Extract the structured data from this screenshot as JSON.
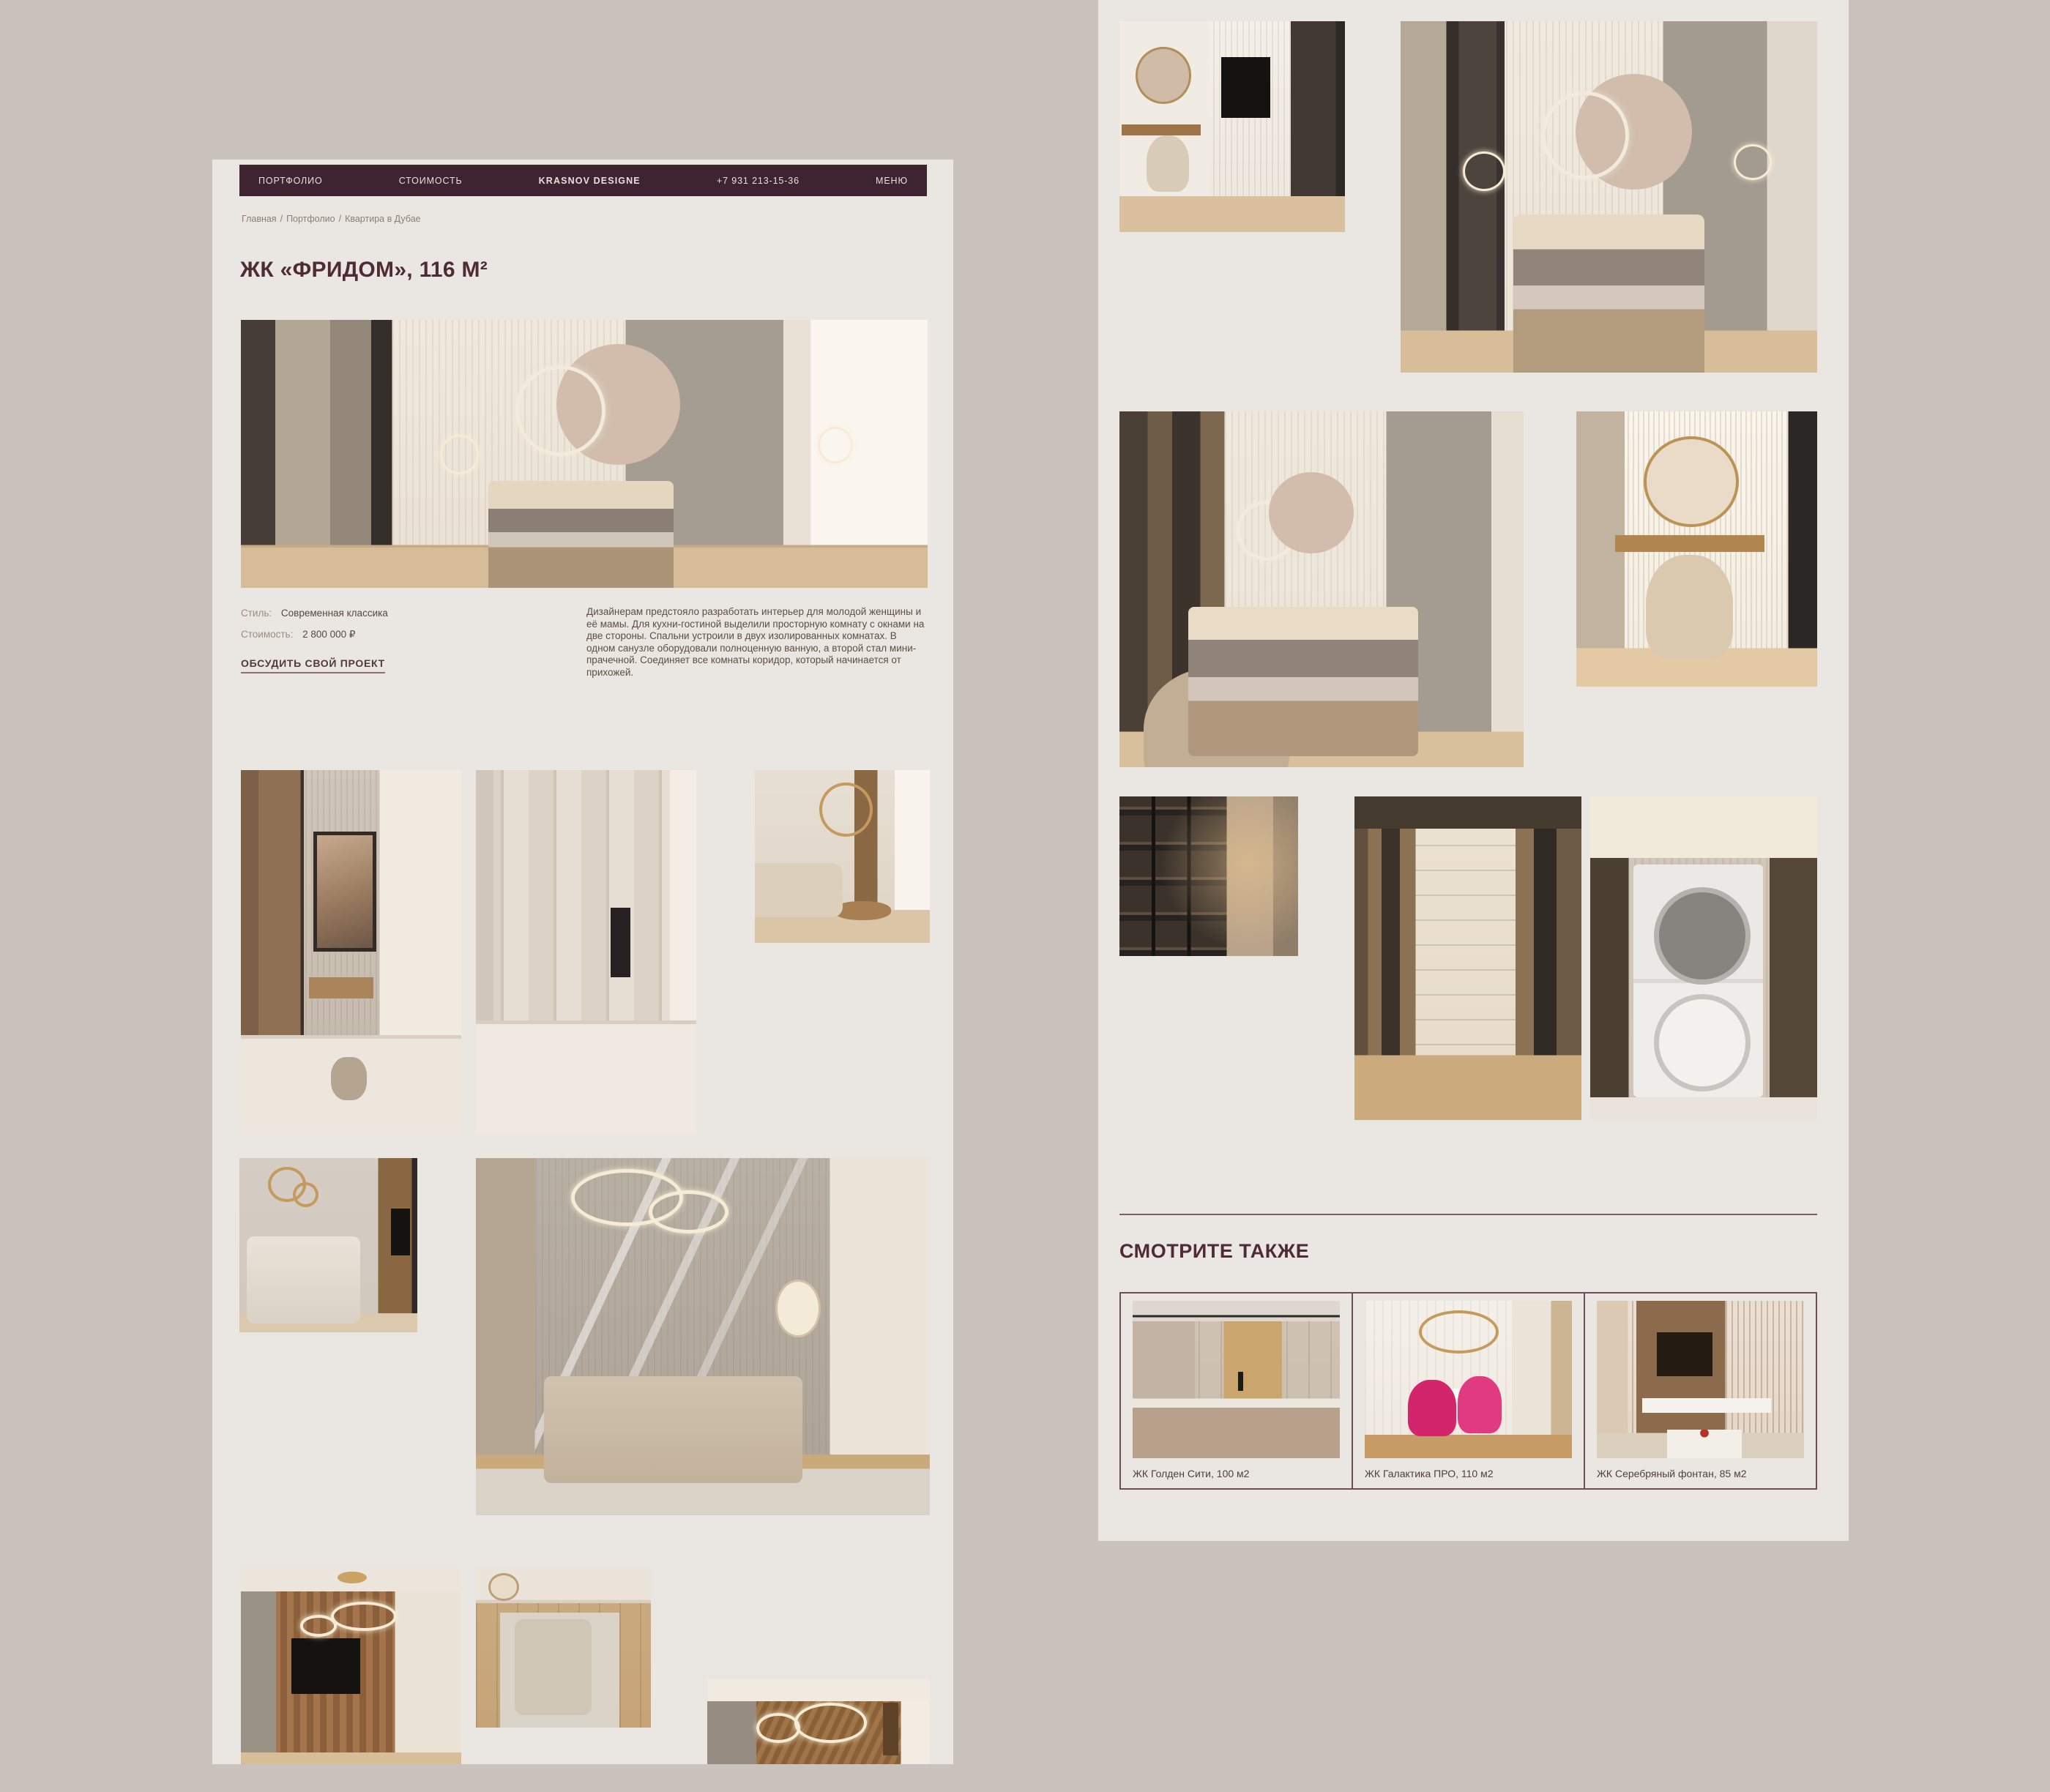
{
  "colors": {
    "canvas": "#cac2bc",
    "page": "#eae6e1",
    "nav_bar": "#3e2430",
    "accent": "#4e2c35",
    "gold": "#c49a5e"
  },
  "left_page": {
    "nav": {
      "portfolio": "ПОРТФОЛИО",
      "pricing": "СТОИМОСТЬ",
      "brand": "KRASNOV DESIGNE",
      "phone": "+7 931 213-15-36",
      "menu": "МЕНЮ"
    },
    "breadcrumb": {
      "home": "Главная",
      "portfolio": "Портфолио",
      "current": "Квартира в Дубае",
      "sep": "/"
    },
    "title": "ЖК «ФРИДОМ», 116 М²",
    "meta": {
      "style_label": "Стиль:",
      "style_value": "Современная классика",
      "price_label": "Стоимость:",
      "price_value": "2 800 000 ₽"
    },
    "cta": "ОБСУДИТЬ СВОЙ ПРОЕКТ",
    "description": "Дизайнерам предстояло разработать интерьер для молодой женщины и её мамы. Для кухни-гостиной выделили просторную комнату с окнами на две стороны. Спальни устроили в двух изолированных комнатах. В одном санузле оборудовали полноценную ванную, а второй стал мини-прачечной. Соединяет все комнаты коридор, который начинается от прихожей."
  },
  "right_page": {
    "see_also": "СМОТРИТЕ ТАКЖЕ",
    "cards": [
      {
        "label": "ЖК Голден Сити, 100 м2"
      },
      {
        "label": "ЖК Галактика ПРО, 110 м2"
      },
      {
        "label": "ЖК Серебряный фонтан, 85 м2"
      }
    ]
  },
  "gallery": {
    "left_page_photos": [
      "hero-bedroom",
      "hallway-entrance",
      "hallway-mirrors",
      "kitchen-living-corner",
      "media-lounge",
      "living-room-panels",
      "tv-wood-wall",
      "sofa-top-view",
      "kitchen-dining"
    ],
    "right_page_photos": [
      "vanity-workspace",
      "bedroom-main",
      "bedroom-wardrobe",
      "vanity-mirror",
      "closet-shelves",
      "walk-in-closet",
      "laundry-niche"
    ]
  }
}
